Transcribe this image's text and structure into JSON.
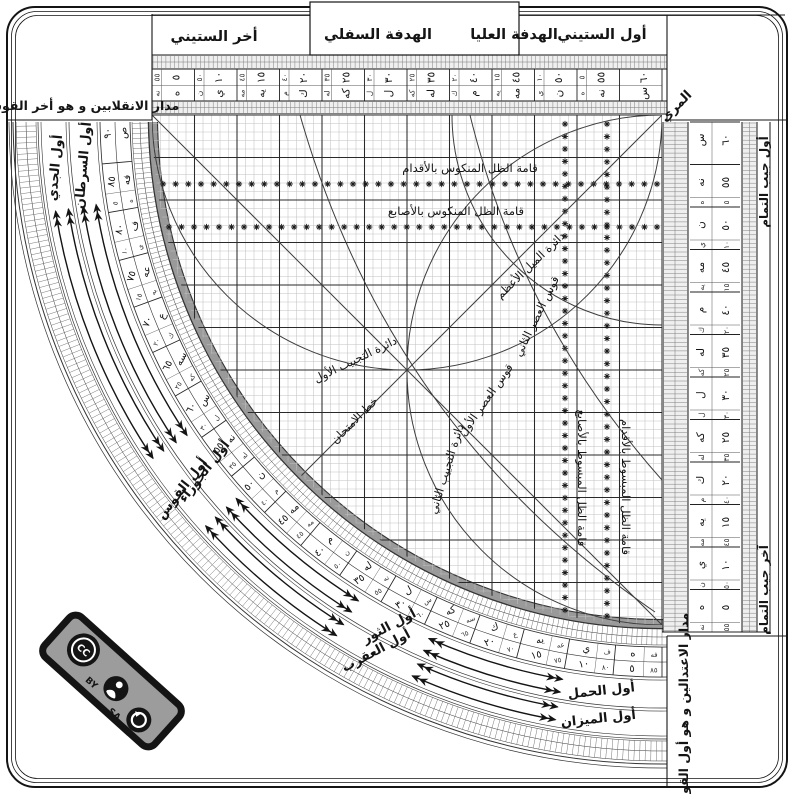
{
  "tabs": {
    "end_sixty": "أخر الستيني",
    "lower_sight": "الهدفة السفلي",
    "upper_sight": "الهدفة العليا",
    "first_sixty": "أول الستيني"
  },
  "corners": {
    "solstice": "مدار الانقلابين و هو أخر القوس",
    "equinox": "مدار الاعتدالين و هو أول القوس",
    "muri": "المري",
    "cosine_first": "أول جيب التمام",
    "cosine_last": "آخر جيب التمام"
  },
  "sexagesimal_scale": {
    "values": [
      60,
      55,
      50,
      45,
      40,
      35,
      30,
      25,
      20,
      15,
      10,
      5
    ],
    "numerals": [
      "٦٠",
      "٥٥",
      "٥٠",
      "٤٥",
      "٤٠",
      "٣٥",
      "٣٠",
      "٢٥",
      "٢٠",
      "١٥",
      "١٠",
      "٥"
    ],
    "abjad": [
      "س",
      "نه",
      "ن",
      "مه",
      "م",
      "له",
      "ل",
      "كه",
      "ك",
      "يه",
      "ي",
      "ه"
    ],
    "minor_values": [
      5,
      10,
      15,
      20,
      25,
      30,
      35,
      40,
      45,
      50,
      55
    ],
    "minor_numerals": [
      "٥",
      "١٠",
      "١٥",
      "٢٠",
      "٢٥",
      "٣٠",
      "٣٥",
      "٤٠",
      "٤٥",
      "٥٠",
      "٥٥"
    ],
    "minor_abjad": [
      "ه",
      "ي",
      "يه",
      "ك",
      "كه",
      "ل",
      "له",
      "م",
      "مه",
      "ن",
      "نه"
    ]
  },
  "arc_scale": {
    "values": [
      90,
      85,
      80,
      75,
      70,
      65,
      60,
      55,
      50,
      45,
      40,
      35,
      30,
      25,
      20,
      15,
      10,
      5
    ],
    "numerals": [
      "٩٠",
      "٨٥",
      "٨٠",
      "٧٥",
      "٧٠",
      "٦٥",
      "٦٠",
      "٥٥",
      "٥٠",
      "٤٥",
      "٤٠",
      "٣٥",
      "٣٠",
      "٢٥",
      "٢٠",
      "١٥",
      "١٠",
      "٥"
    ],
    "abjad": [
      "ص",
      "فه",
      "ف",
      "عه",
      "ع",
      "سه",
      "س",
      "نه",
      "ن",
      "مه",
      "م",
      "له",
      "ل",
      "كه",
      "ك",
      "يه",
      "ي",
      "ه"
    ],
    "minor_numerals": [
      "٥",
      "١٠",
      "١٥",
      "٢٠",
      "٢٥",
      "٣٠",
      "٣٥",
      "٤٠",
      "٤٥",
      "٥٠",
      "٥٥",
      "٦٠",
      "٦٥",
      "٧٠",
      "٧٥",
      "٨٠",
      "٨٥"
    ],
    "minor_abjad": [
      "ه",
      "ي",
      "يه",
      "ك",
      "كه",
      "ل",
      "له",
      "م",
      "مه",
      "ن",
      "نه",
      "س",
      "سه",
      "ع",
      "عه",
      "ف",
      "فه"
    ]
  },
  "zodiac": {
    "positions_deg": [
      6,
      28,
      52,
      85
    ],
    "inner_track": [
      "أول الحمل",
      "أول الثور",
      "أول الجوزاء",
      "أول السرطان"
    ],
    "outer_track": [
      "أول الميزان",
      "أول العقرب",
      "أول القوس",
      "أول الجدي"
    ]
  },
  "grid_curves": {
    "nakus_feet": "قامة الظل المنكوس بالأقدام",
    "nakus_digits": "قامة الظل المنكوس بالأصابع",
    "mabsut_digits": "قامة الظل المبسوط بالأصابع",
    "mabsut_feet": "قامة الظل المبسوط بالأقدام",
    "mayl": "دائرة الميل الأعظم",
    "asr2": "قوس العصر الثاني",
    "asr1": "قوس العصر الأول",
    "tajyib1": "دائرة التجييب الأول",
    "tajyib2": "دائرة التجييب الثاني",
    "imtihan": "خط الامتحان"
  },
  "license": {
    "cc": "CC",
    "by": "BY",
    "sa": "SA",
    "icons": [
      "cc-logo",
      "attribution-person",
      "share-alike-arrow"
    ]
  },
  "colors": {
    "ink": "#141414",
    "grid_fine": "#c2c2c2",
    "grid_bold": "#2a2a2a",
    "band_gray": "#9a9a9a",
    "hatch_fill": "#efefef",
    "badge_gray": "#9c9c9c",
    "curve": "#3d3d3d"
  }
}
